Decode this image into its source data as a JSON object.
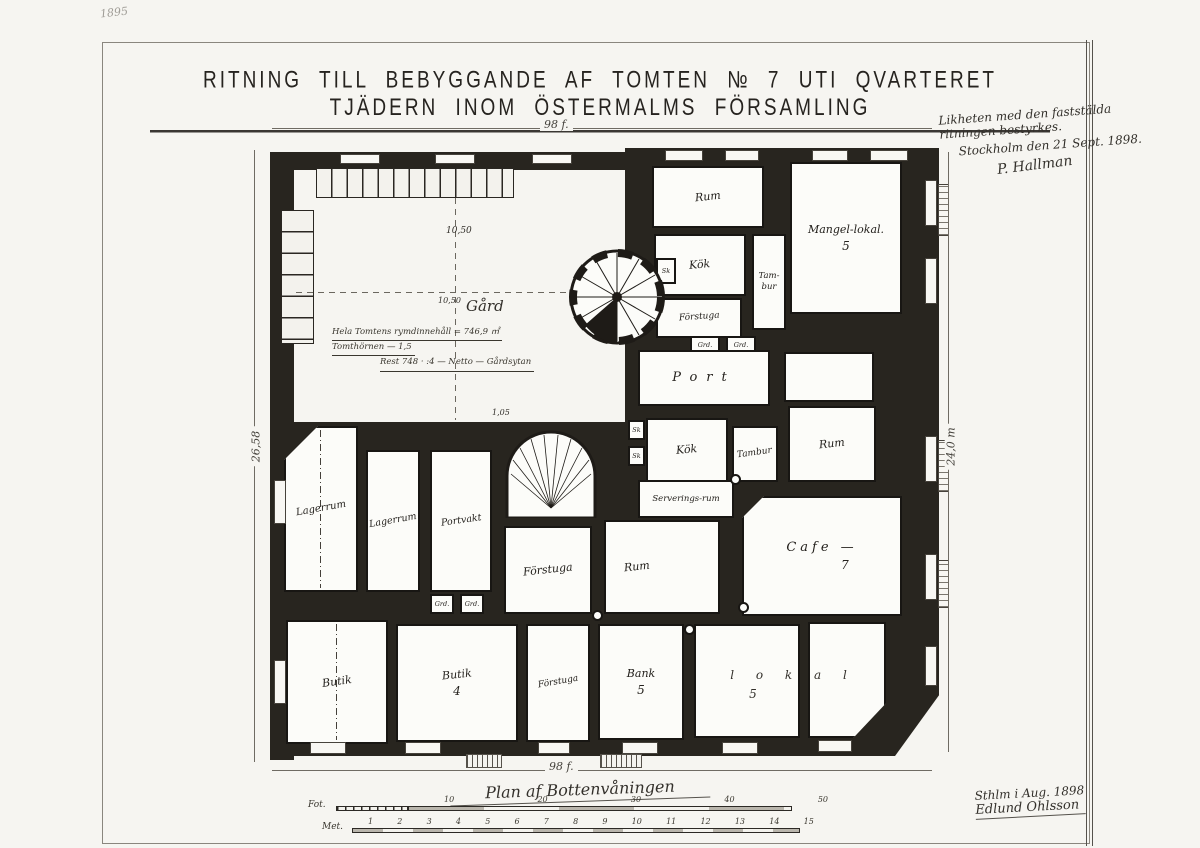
{
  "title": "RITNING TILL BEBYGGANDE AF TOMTEN № 7 UTI QVARTERET TJÄDERN INOM ÖSTERMALMS FÖRSAMLING",
  "pencil_note": "1895",
  "approval_note": {
    "line1": "Likheten med den faststälda",
    "line2": "ritningen bestyrkes.",
    "line3": "Stockholm den 21 Sept. 1898.",
    "signature": "P. Hallman"
  },
  "courtyard": {
    "level_mark": "10,50",
    "gard_level": "10,50",
    "label": "Gård",
    "calc_line1": "Hela Tomtens rymdinnehåll = 746,9 ㎡",
    "calc_line2": "Tomthörnen  —  1,5",
    "calc_line3": "Rest 748 · :4 — Netto — Gårdsytan",
    "small_mark": "1,05"
  },
  "rooms": {
    "rum_top": "Rum",
    "mangel": "Mangel-lokal.",
    "mangel_num": "5",
    "kok_top": "Kök",
    "sk_top": "Sk",
    "tambur_top_a": "Tam-",
    "tambur_top_b": "bur",
    "forstuga_top": "Förstuga",
    "grd_a": "Grd.",
    "grd_b": "Grd.",
    "port": "Port",
    "rum_right": "Rum",
    "kok_mid": "Kök",
    "sk_mid_a": "Sk",
    "sk_mid_b": "Sk",
    "tambur_mid": "Tambur",
    "serveringsrum": "Serverings-rum",
    "cafe": "Cafe —",
    "cafe_num": "7",
    "lagerrum1": "Lagerrum",
    "lagerrum2": "Lagerrum",
    "portvakt": "Portvakt",
    "forstuga_mid": "Förstuga",
    "rum_center": "Rum",
    "grd_c": "Grd.",
    "grd_d": "Grd.",
    "butik1": "Butik",
    "butik4": "Butik",
    "butik4_num": "4",
    "forstuga_bot": "Förstuga",
    "bank": "Bank",
    "bank_num": "5",
    "lokal": "l o k a l",
    "lokal_num": "5"
  },
  "dimensions": {
    "top": "98 f.",
    "bottom": "98 f.",
    "left": "26,58",
    "right": "24,0 m"
  },
  "caption": "Plan af Bottenvåningen",
  "scales": {
    "fot_label": "Fot.",
    "fot_ticks": [
      "10",
      "20",
      "30",
      "40",
      "50"
    ],
    "meter_label": "Met.",
    "meter_ticks": [
      "1",
      "2",
      "3",
      "4",
      "5",
      "6",
      "7",
      "8",
      "9",
      "10",
      "11",
      "12",
      "13",
      "14",
      "15"
    ]
  },
  "signature_block": {
    "line1": "Sthlm i Aug. 1898",
    "line2": "Edlund Ohlsson"
  }
}
